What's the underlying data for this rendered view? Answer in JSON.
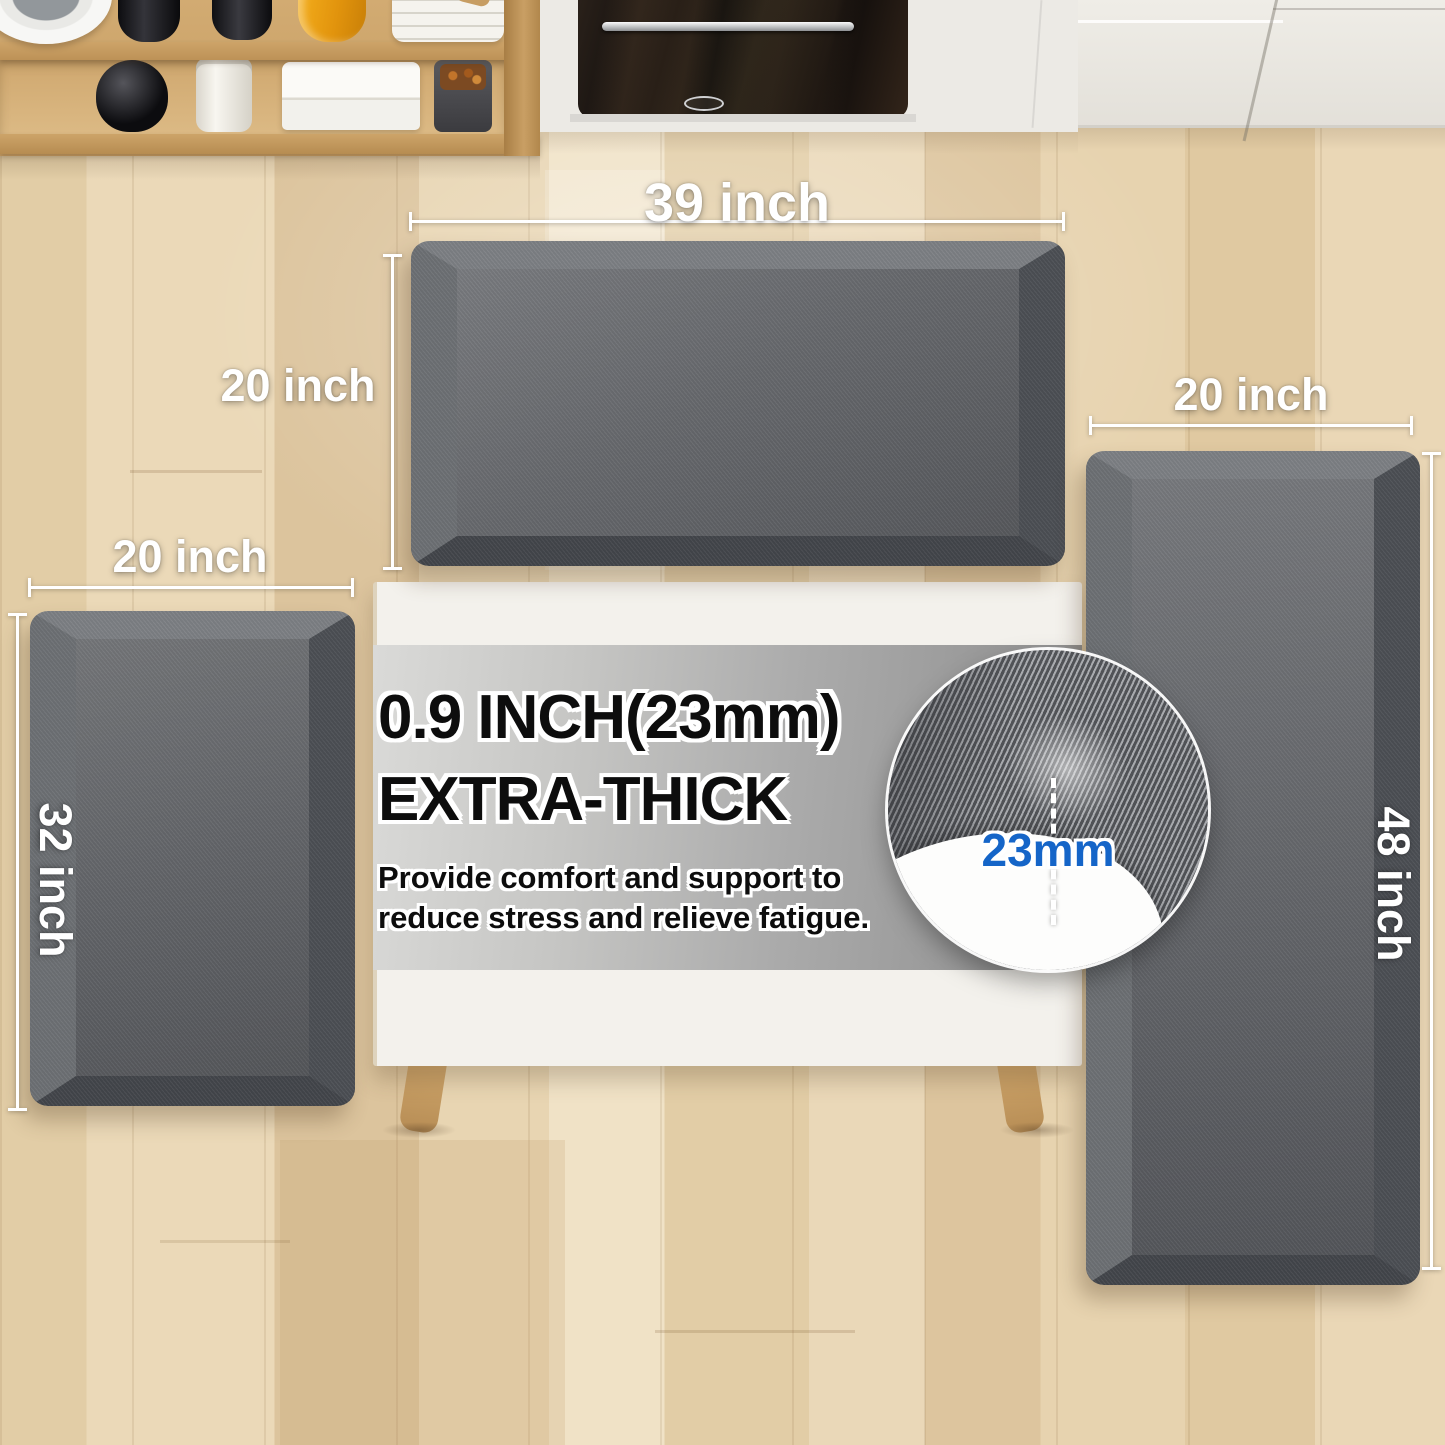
{
  "product": {
    "mats": {
      "top": {
        "width_label": "39 inch",
        "height_label": "20 inch"
      },
      "left": {
        "width_label": "20 inch",
        "height_label": "32 inch"
      },
      "right": {
        "width_label": "20 inch",
        "height_label": "48 inch"
      }
    },
    "callout": {
      "title_line1": "0.9 INCH(23mm)",
      "title_line2": "EXTRA-THICK",
      "body_line1": "Provide comfort and support to",
      "body_line2": "reduce stress and relieve fatigue."
    },
    "inset": {
      "thickness_label": "23mm"
    }
  },
  "colors": {
    "mat_gray": "#64666b",
    "accent_blue": "#1565c8",
    "floor_wood": "#e6d2ae",
    "shelf_wood": "#c49c62",
    "table_white": "#f3f1ec",
    "banner_gray_light": "#dadad8",
    "banner_gray_dark": "#8d8d8d",
    "label_white": "#ffffff",
    "text_black": "#0d0d0d"
  }
}
